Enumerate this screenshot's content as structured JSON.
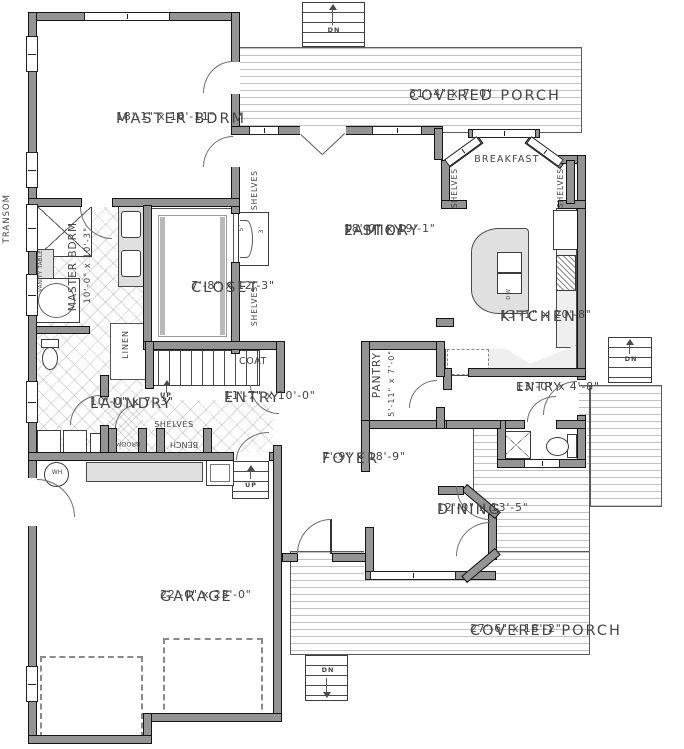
{
  "rooms": {
    "master": {
      "name": "MASTER BDRM",
      "dims": "18'-1\" x 16'-11\""
    },
    "porch_top": {
      "name": "COVERED PORCH",
      "dims": "31'-4\" x 7'-0\""
    },
    "breakfast": {
      "name": "BREAKFAST"
    },
    "family": {
      "line1": "2-STORY",
      "line2": "FAMILY",
      "dims": "18'-0\" x 19'-1\""
    },
    "kitchen": {
      "name": "KITCHEN",
      "dims": "13'-1\" x 20'-8\""
    },
    "closet": {
      "name": "CLOSET",
      "dims": "7'-8\" x 12'-3\""
    },
    "master_bath": {
      "name": "MASTER BDRM",
      "dims": "10'-0\" x 10'-3\""
    },
    "laundry": {
      "name": "LAUNDRY",
      "dims": "10'-0\" x 7'-3\""
    },
    "entry": {
      "name": "ENTRY",
      "dims": "11'-7\" x 10'-0\""
    },
    "pantry": {
      "name": "PANTRY",
      "dims": "5'-11\" x 7'-0\""
    },
    "rear_entry": {
      "name": "ENTRY",
      "dims": "13'-0\" x 4'-8\""
    },
    "foyer": {
      "name": "FOYER",
      "dims": "7'-9\" x 18'-9\""
    },
    "dining": {
      "name": "DINING",
      "dims": "12'-0\" x 13'-5\""
    },
    "garage": {
      "name": "GARAGE",
      "dims": "22'-0\" x 23'-0\""
    },
    "porch_bottom": {
      "name": "COVERED PORCH",
      "dims": "27'-6\" x 18'-2\""
    }
  },
  "annotations": {
    "transom": "TRANSOM",
    "vanity_table": "VANITY TABLE",
    "shelves": "SHELVES",
    "linen": "LINEN",
    "coat": "COAT",
    "broom": "BROOM",
    "bench": "BENCH",
    "water_heater": "WH",
    "dishwasher": "DW",
    "up": "UP",
    "down": "DN",
    "niche_dim_a": "5'",
    "niche_dim_b": "3'"
  },
  "colors": {
    "wall": "#949494",
    "deck_line": "#c2c2c2",
    "counter": "#e0e0e0",
    "text": "#454545"
  }
}
